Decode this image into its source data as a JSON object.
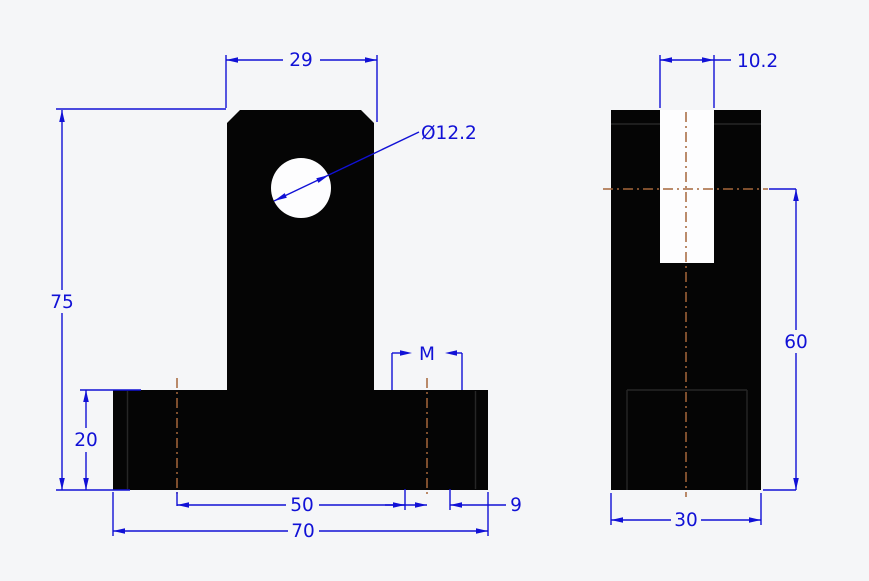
{
  "drawing": {
    "type": "CAD 2D engineering drawing, two orthographic views of a T-shaped bracket",
    "colors": {
      "background": "#f5f6f8",
      "dimension": "#1111d6",
      "centerline": "#a5673b",
      "part_fill": "#050505",
      "part_edge": "#262626",
      "hole_fill": "#fdfdfe"
    },
    "front_view": {
      "label": "front view (T-shaped bracket with chamfered top and through hole)",
      "dims": {
        "column_width": "29",
        "hole_diameter": "Ø12.2",
        "overall_height": "75",
        "base_height": "20",
        "thread_callout": "M",
        "hole_spacing": "50",
        "drill_diameter": "9",
        "base_width": "70"
      }
    },
    "side_view": {
      "label": "side view (block with top slot)",
      "dims": {
        "slot_width": "10.2",
        "hole_axis_height": "60",
        "depth": "30"
      }
    }
  }
}
